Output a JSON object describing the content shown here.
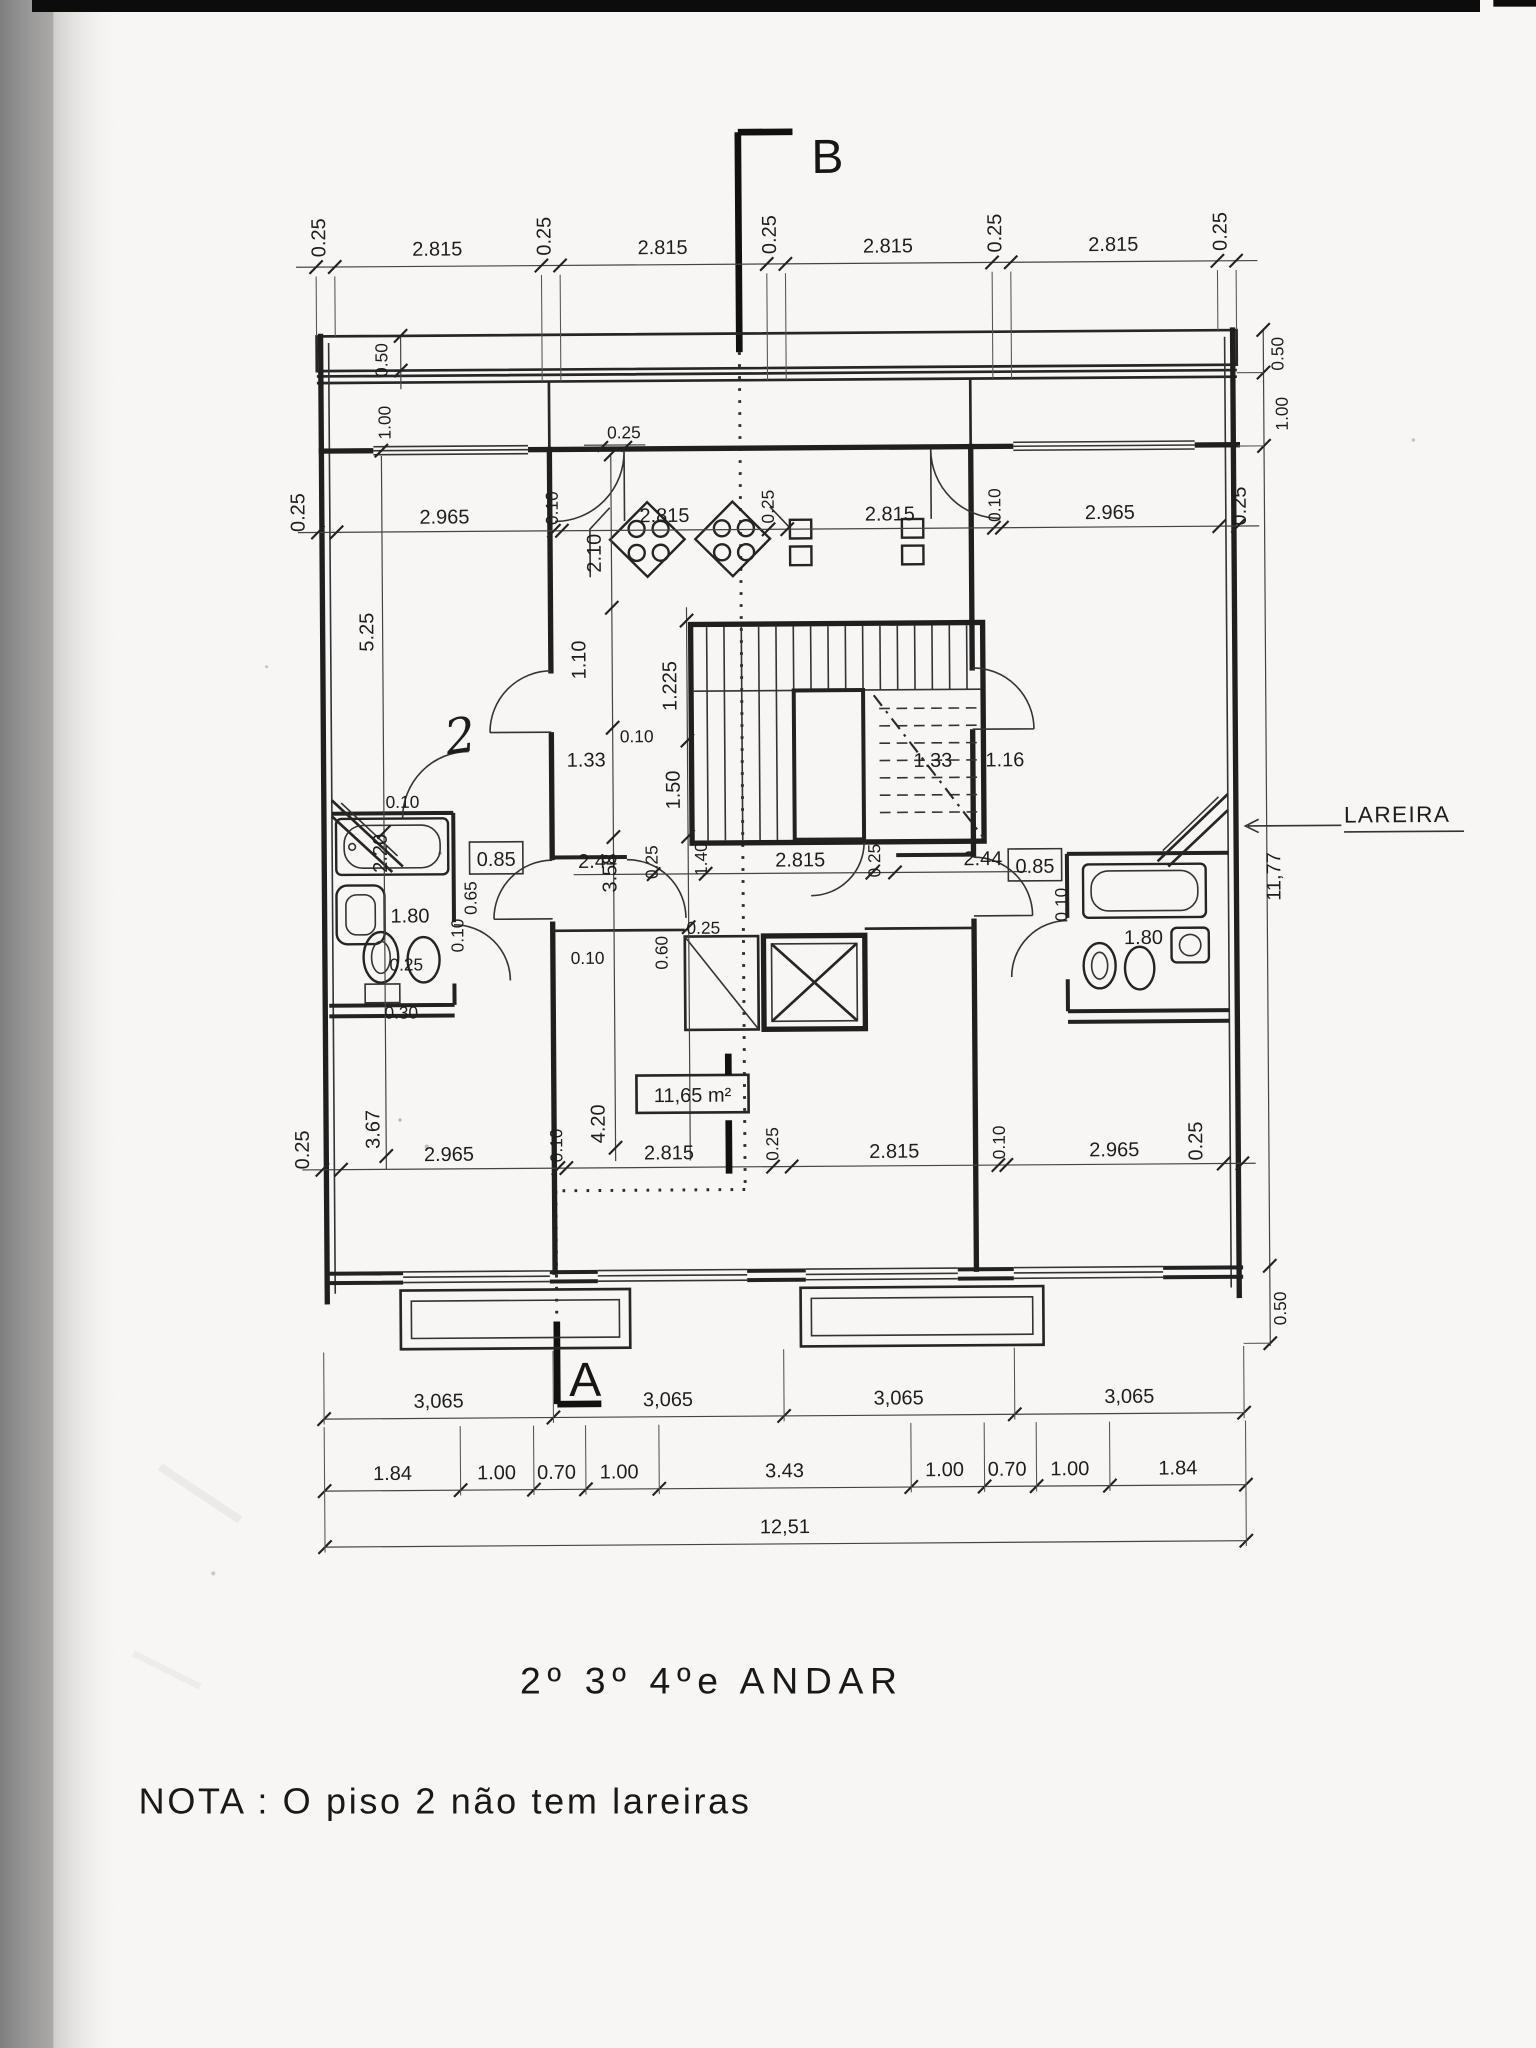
{
  "markers": {
    "b": "B",
    "a": "A"
  },
  "callouts": {
    "lareira": "LAREIRA",
    "area_label": "11,65 m²",
    "handwritten_note": "2"
  },
  "title": "2º 3º 4ºe ANDAR",
  "note": "NOTA : O piso 2 não tem lareiras",
  "dims": {
    "top_chain": [
      "0.25",
      "2.815",
      "0.25",
      "2.815",
      "0.25",
      "2.815",
      "0.25",
      "2.815",
      "0.25"
    ],
    "upper_rooms": [
      "0.25",
      "2.965",
      "0.10",
      "2.815",
      "0.25",
      "2.815",
      "0.10",
      "2.965",
      "0.25"
    ],
    "lower_rooms": [
      "0.25",
      "2.965",
      "0.10",
      "2.815",
      "0.25",
      "2.815",
      "0.10",
      "2.965",
      "0.25"
    ],
    "lower_heights": [
      "3.67",
      "4.20"
    ],
    "hall_row": [
      "2.44",
      "0.25",
      "1.40",
      "2.815",
      "0.25",
      "2.44"
    ],
    "stair_zone": [
      "2.10",
      "1.10",
      "1.225",
      "0.10",
      "1.33",
      "1.50",
      "1.33",
      "1.16",
      "3.58",
      "0.10",
      "0.60",
      "0.25"
    ],
    "center_top": [
      "0.25"
    ],
    "left_side": [
      "0.50",
      "1.00",
      "5.25",
      "0.30",
      "0.25"
    ],
    "right_side": [
      "0.50",
      "1.00",
      "11,77",
      "0.50"
    ],
    "bath_left": [
      "0.10",
      "2.20",
      "0.85",
      "0.65",
      "1.80",
      "0.10"
    ],
    "bath_right": [
      "0.85",
      "0.10",
      "1.80"
    ],
    "row_3065": [
      "3,065",
      "3,065",
      "3,065",
      "3,065"
    ],
    "row_fine": [
      "1.84",
      "1.00",
      "0.70",
      "1.00",
      "3.43",
      "1.00",
      "0.70",
      "1.00",
      "1.84"
    ],
    "row_total": "12,51"
  },
  "colors": {
    "ink": "#1d1d1d",
    "paper": "#f7f6f4",
    "scan_edge": "#7c7c7c",
    "top_bar": "#0c0c0c"
  }
}
